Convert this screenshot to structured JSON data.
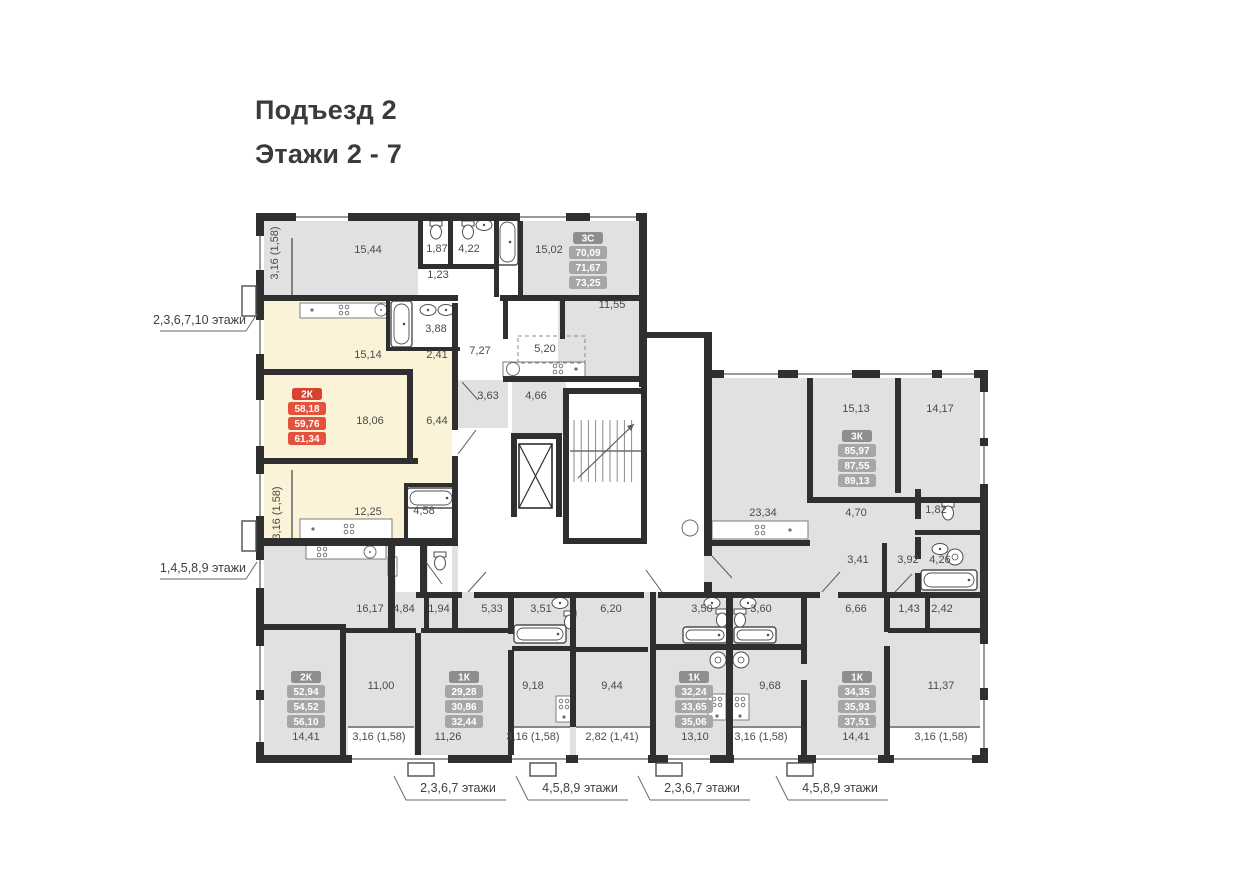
{
  "title": {
    "line1": "Подъезд 2",
    "line2": "Этажи 2 - 7"
  },
  "colors": {
    "wall": "#2f2f2f",
    "room_gray": "#e1e1e2",
    "highlight_yellow": "#faf3d7",
    "white": "#ffffff",
    "accent_red_header": "#d64331",
    "accent_red_row": "#e4523e",
    "badge_gray_header": "#8e8e8e",
    "badge_gray_row": "#a6a6a6",
    "text": "#4a4a4a",
    "fixture_stroke": "#4f4f4f",
    "window_line": "#9a9a9a"
  },
  "apartments": [
    {
      "type": "3С",
      "areas": [
        "70,09",
        "71,67",
        "73,25"
      ],
      "highlighted": false,
      "x": 588,
      "y": 232
    },
    {
      "type": "2К",
      "areas": [
        "58,18",
        "59,76",
        "61,34"
      ],
      "highlighted": true,
      "x": 307,
      "y": 388
    },
    {
      "type": "3К",
      "areas": [
        "85,97",
        "87,55",
        "89,13"
      ],
      "highlighted": false,
      "x": 857,
      "y": 430
    },
    {
      "type": "2К",
      "areas": [
        "52,94",
        "54,52",
        "56,10"
      ],
      "highlighted": false,
      "x": 306,
      "y": 671
    },
    {
      "type": "1К",
      "areas": [
        "29,28",
        "30,86",
        "32,44"
      ],
      "highlighted": false,
      "x": 464,
      "y": 671
    },
    {
      "type": "1К",
      "areas": [
        "32,24",
        "33,65",
        "35,06"
      ],
      "highlighted": false,
      "x": 694,
      "y": 671
    },
    {
      "type": "1К",
      "areas": [
        "34,35",
        "35,93",
        "37,51"
      ],
      "highlighted": false,
      "x": 857,
      "y": 671
    }
  ],
  "rooms": [
    {
      "t": "3,16 (1,58)",
      "x": 278,
      "y": 253,
      "v": true
    },
    {
      "t": "15,44",
      "x": 368,
      "y": 253
    },
    {
      "t": "1,87",
      "x": 437,
      "y": 252
    },
    {
      "t": "4,22",
      "x": 469,
      "y": 252
    },
    {
      "t": "1,23",
      "x": 438,
      "y": 278
    },
    {
      "t": "15,02",
      "x": 549,
      "y": 253
    },
    {
      "t": "11,55",
      "x": 612,
      "y": 308
    },
    {
      "t": "3,88",
      "x": 436,
      "y": 332
    },
    {
      "t": "2,41",
      "x": 437,
      "y": 358
    },
    {
      "t": "7,27",
      "x": 480,
      "y": 354
    },
    {
      "t": "5,20",
      "x": 545,
      "y": 352
    },
    {
      "t": "15,14",
      "x": 368,
      "y": 358
    },
    {
      "t": "3,63",
      "x": 488,
      "y": 399
    },
    {
      "t": "4,66",
      "x": 536,
      "y": 399
    },
    {
      "t": "18,06",
      "x": 370,
      "y": 424
    },
    {
      "t": "6,44",
      "x": 437,
      "y": 424
    },
    {
      "t": "12,25",
      "x": 368,
      "y": 515
    },
    {
      "t": "4,58",
      "x": 424,
      "y": 514
    },
    {
      "t": "3,16 (1,58)",
      "x": 280,
      "y": 513,
      "v": true
    },
    {
      "t": "15,13",
      "x": 856,
      "y": 412
    },
    {
      "t": "14,17",
      "x": 940,
      "y": 412
    },
    {
      "t": "23,34",
      "x": 763,
      "y": 516
    },
    {
      "t": "4,70",
      "x": 856,
      "y": 516
    },
    {
      "t": "1,82",
      "x": 936,
      "y": 513
    },
    {
      "t": "3,41",
      "x": 858,
      "y": 563
    },
    {
      "t": "3,92",
      "x": 908,
      "y": 563
    },
    {
      "t": "4,26",
      "x": 940,
      "y": 563
    },
    {
      "t": "16,17",
      "x": 370,
      "y": 612
    },
    {
      "t": "4,84",
      "x": 404,
      "y": 612
    },
    {
      "t": "1,94",
      "x": 439,
      "y": 612
    },
    {
      "t": "5,33",
      "x": 492,
      "y": 612
    },
    {
      "t": "3,51",
      "x": 541,
      "y": 612
    },
    {
      "t": "6,20",
      "x": 611,
      "y": 612
    },
    {
      "t": "3,50",
      "x": 702,
      "y": 612
    },
    {
      "t": "3,60",
      "x": 761,
      "y": 612
    },
    {
      "t": "6,66",
      "x": 856,
      "y": 612
    },
    {
      "t": "1,43",
      "x": 909,
      "y": 612
    },
    {
      "t": "2,42",
      "x": 942,
      "y": 612
    },
    {
      "t": "11,00",
      "x": 381,
      "y": 689
    },
    {
      "t": "9,18",
      "x": 533,
      "y": 689
    },
    {
      "t": "9,44",
      "x": 612,
      "y": 689
    },
    {
      "t": "9,68",
      "x": 770,
      "y": 689
    },
    {
      "t": "11,37",
      "x": 941,
      "y": 689
    },
    {
      "t": "14,41",
      "x": 306,
      "y": 740
    },
    {
      "t": "3,16 (1,58)",
      "x": 379,
      "y": 740
    },
    {
      "t": "11,26",
      "x": 448,
      "y": 740
    },
    {
      "t": "3,16 (1,58)",
      "x": 533,
      "y": 740
    },
    {
      "t": "2,82 (1,41)",
      "x": 612,
      "y": 740
    },
    {
      "t": "13,10",
      "x": 695,
      "y": 740
    },
    {
      "t": "3,16 (1,58)",
      "x": 761,
      "y": 740
    },
    {
      "t": "14,41",
      "x": 856,
      "y": 740
    },
    {
      "t": "3,16 (1,58)",
      "x": 941,
      "y": 740
    }
  ],
  "floor_labels": {
    "left": [
      {
        "text": "2,3,6,7,10 этажи",
        "x": 246,
        "y": 324
      },
      {
        "text": "1,4,5,8,9 этажи",
        "x": 246,
        "y": 572
      }
    ],
    "bottom": [
      {
        "text": "2,3,6,7 этажи",
        "x": 458,
        "y": 792
      },
      {
        "text": "4,5,8,9 этажи",
        "x": 580,
        "y": 792
      },
      {
        "text": "2,3,6,7 этажи",
        "x": 702,
        "y": 792
      },
      {
        "text": "4,5,8,9 этажи",
        "x": 840,
        "y": 792
      }
    ]
  }
}
